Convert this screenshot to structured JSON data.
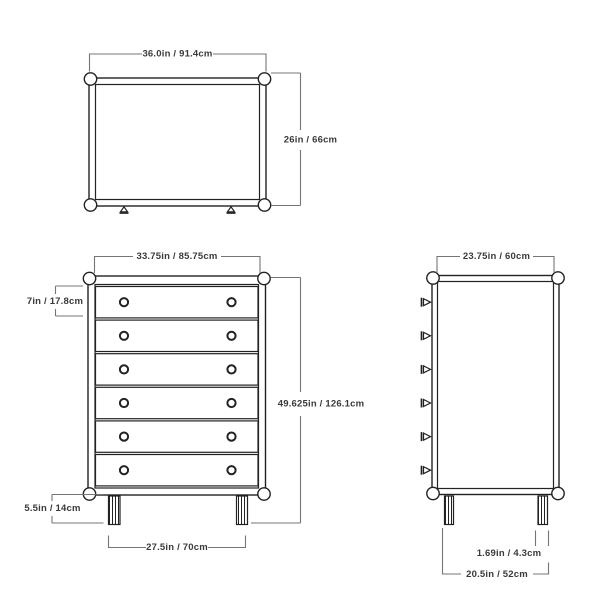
{
  "drawing": {
    "title": "Dresser dimension drawing",
    "colors": {
      "background": "#ffffff",
      "furniture_outline": "#222222",
      "dimension_line": "#757575",
      "label_text": "#3a3a3a"
    },
    "views": {
      "top": {
        "name": "top-view",
        "width_label": "36.0in / 91.4cm",
        "depth_label": "26in / 66cm",
        "knob_count": 2
      },
      "front": {
        "name": "front-view",
        "width_label": "33.75in / 85.75cm",
        "drawer_height_label": "7in / 17.8cm",
        "total_height_label": "49.625in / 126.1cm",
        "leg_height_label": "5.5in / 14cm",
        "leg_span_label": "27.5in / 70cm",
        "drawer_count": 6,
        "knobs_per_drawer": 2
      },
      "side": {
        "name": "side-view",
        "depth_label": "23.75in / 60cm",
        "leg_width_label": "1.69in / 4.3cm",
        "leg_span_label": "20.5in / 52cm",
        "knob_profile_count": 6
      }
    }
  }
}
